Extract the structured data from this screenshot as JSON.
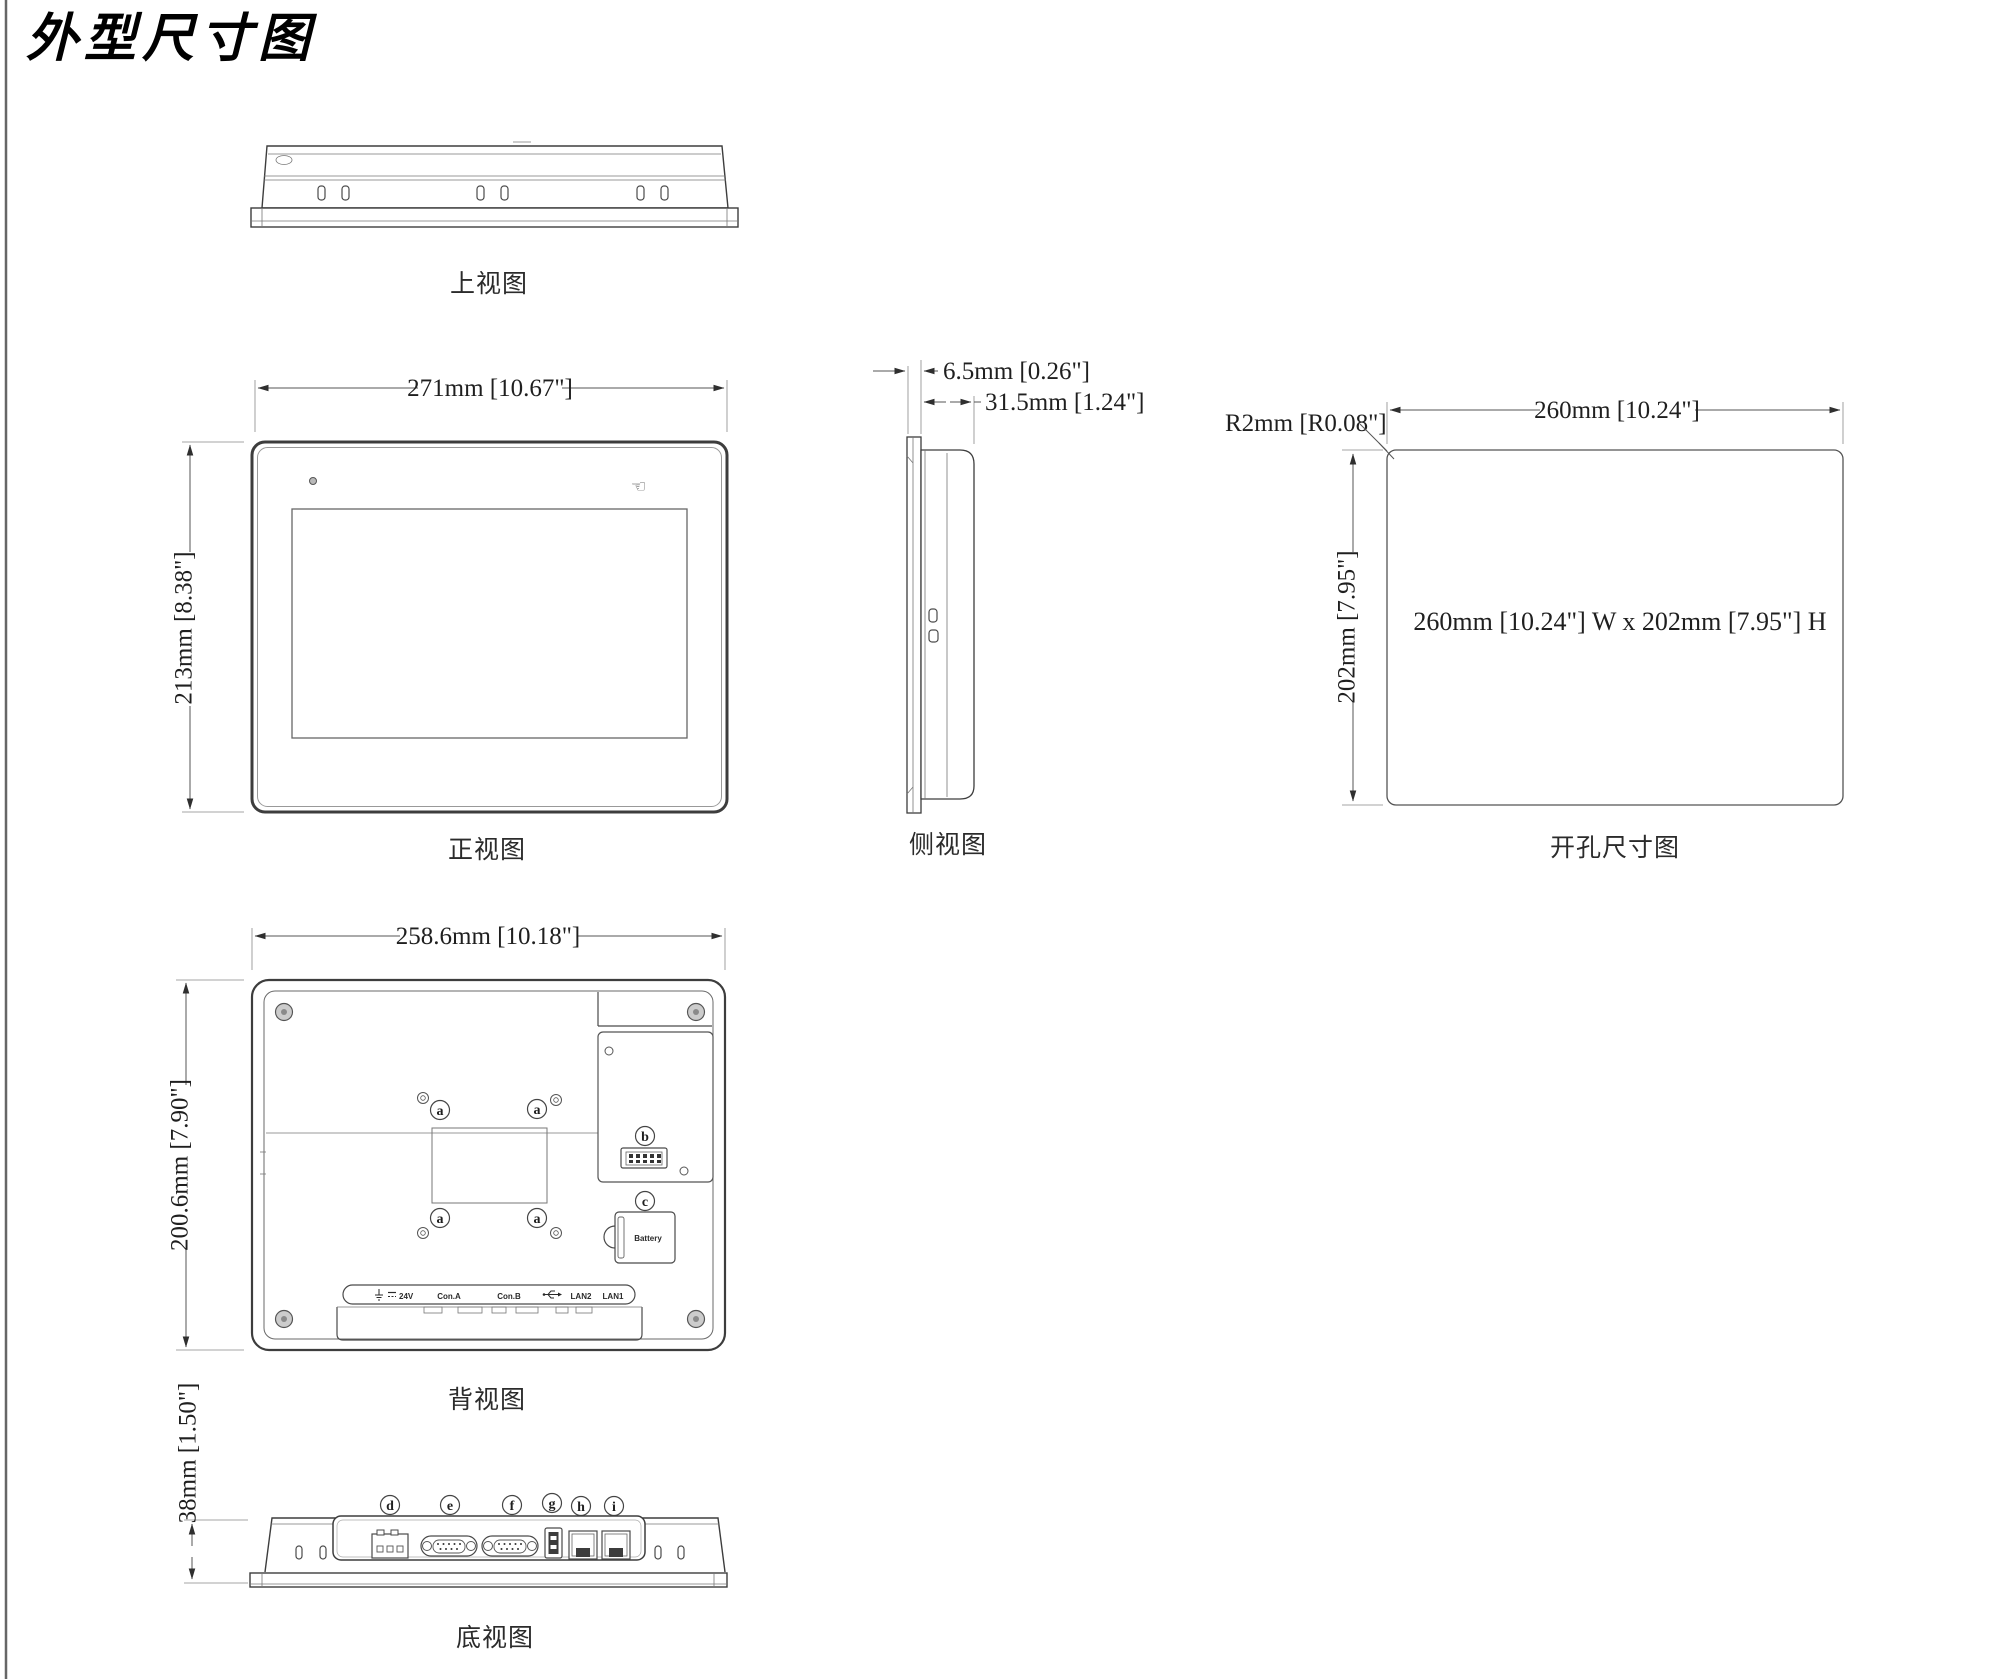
{
  "page": {
    "title": "外型尺寸图"
  },
  "views": {
    "top": {
      "label": "上视图"
    },
    "front": {
      "label": "正视图",
      "dim_width": "271mm [10.67\"]",
      "dim_height": "213mm [8.38\"]"
    },
    "side": {
      "label": "侧视图",
      "dim_bezel": "6.5mm [0.26\"]",
      "dim_depth": "31.5mm [1.24\"]"
    },
    "cutout": {
      "label": "开孔尺寸图",
      "dim_width": "260mm [10.24\"]",
      "dim_height": "202mm [7.95\"]",
      "dim_radius": "R2mm [R0.08\"]",
      "note": "260mm [10.24\"] W x 202mm [7.95\"] H"
    },
    "rear": {
      "label": "背视图",
      "dim_width": "258.6mm [10.18\"]",
      "dim_height": "200.6mm [7.90\"]",
      "callout_a": "a",
      "callout_b": "b",
      "callout_c": "c",
      "battery_label": "Battery",
      "ports": {
        "power_voltage": "24V",
        "con_a": "Con.A",
        "con_b": "Con.B",
        "lan2": "LAN2",
        "lan1": "LAN1"
      }
    },
    "bottom": {
      "label": "底视图",
      "dim_height": "38mm [1.50\"]",
      "callouts": {
        "d": "d",
        "e": "e",
        "f": "f",
        "g": "g",
        "h": "h",
        "i": "i"
      }
    }
  }
}
